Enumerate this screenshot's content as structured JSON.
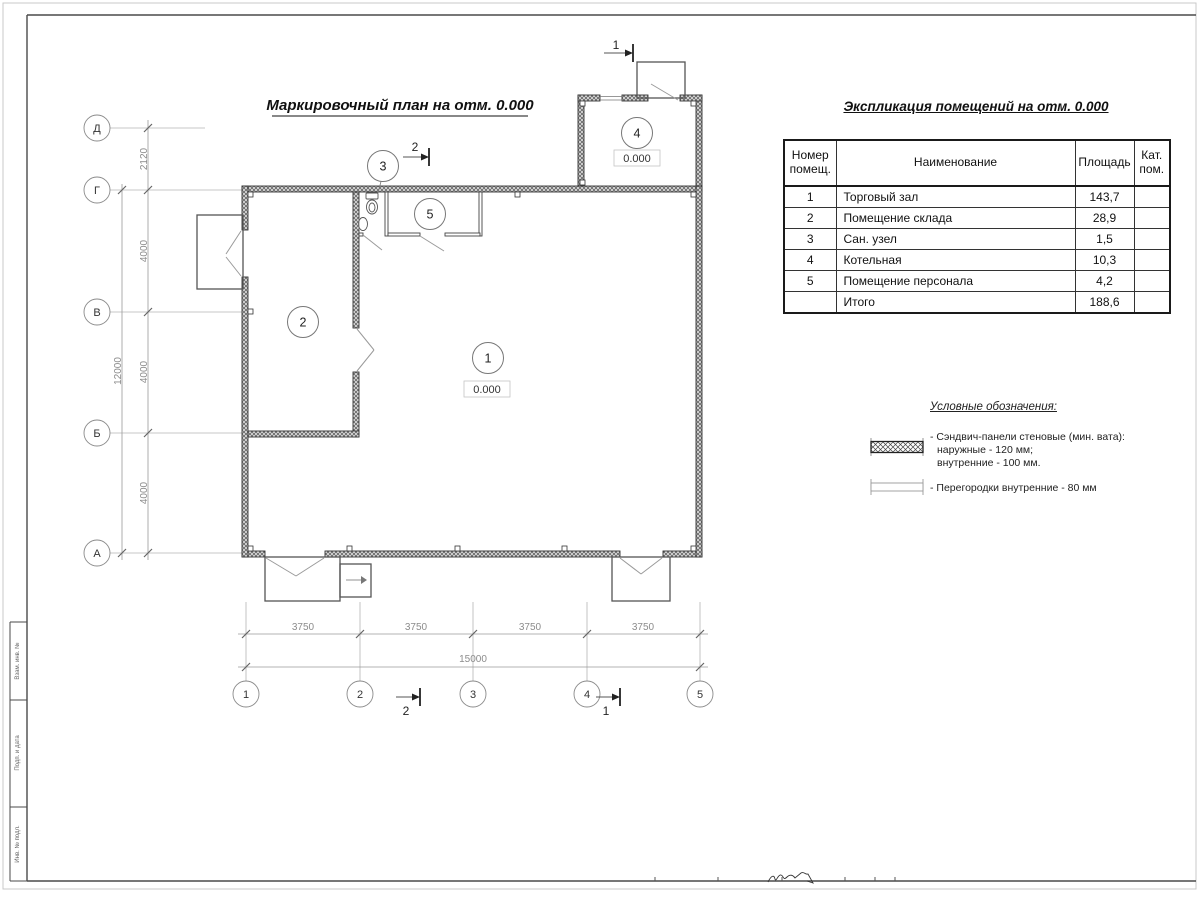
{
  "sheet": {
    "stamp_labels": [
      "Взам. инв. №",
      "Подп. и дата",
      "Инв. № подл."
    ]
  },
  "plan": {
    "title": "Маркировочный план на отм. 0.000",
    "axes_left": [
      "Д",
      "Г",
      "В",
      "Б",
      "А"
    ],
    "axes_bottom": [
      "1",
      "2",
      "3",
      "4",
      "5"
    ],
    "dims_left": [
      "2120",
      "4000",
      "4000",
      "4000"
    ],
    "dim_left_total": "12000",
    "dims_bottom": [
      "3750",
      "3750",
      "3750",
      "3750"
    ],
    "dim_bottom_total": "15000",
    "rooms": [
      {
        "num": "1",
        "level": "0.000"
      },
      {
        "num": "2"
      },
      {
        "num": "3"
      },
      {
        "num": "4",
        "level": "0.000"
      },
      {
        "num": "5"
      }
    ],
    "sections": {
      "top_1": "1",
      "top_2": "2",
      "bottom_1": "1",
      "bottom_2": "2"
    }
  },
  "table": {
    "title": "Экспликация помещений на отм. 0.000",
    "headers": {
      "num": "Номер помещ.",
      "name": "Наименование",
      "area": "Площадь",
      "cat": "Кат. пом."
    },
    "rows": [
      {
        "num": "1",
        "name": "Торговый зал",
        "area": "143,7",
        "cat": ""
      },
      {
        "num": "2",
        "name": "Помещение склада",
        "area": "28,9",
        "cat": ""
      },
      {
        "num": "3",
        "name": "Сан. узел",
        "area": "1,5",
        "cat": ""
      },
      {
        "num": "4",
        "name": "Котельная",
        "area": "10,3",
        "cat": ""
      },
      {
        "num": "5",
        "name": "Помещение персонала",
        "area": "4,2",
        "cat": ""
      },
      {
        "num": "",
        "name": "Итого",
        "area": "188,6",
        "cat": ""
      }
    ]
  },
  "legend": {
    "title": "Условные обозначения:",
    "items": [
      {
        "lines": [
          "- Сэндвич-панели стеновые (мин. вата):",
          "наружные - 120 мм;",
          "внутренние - 100 мм."
        ]
      },
      {
        "lines": [
          "- Перегородки внутренние - 80 мм"
        ]
      }
    ]
  }
}
